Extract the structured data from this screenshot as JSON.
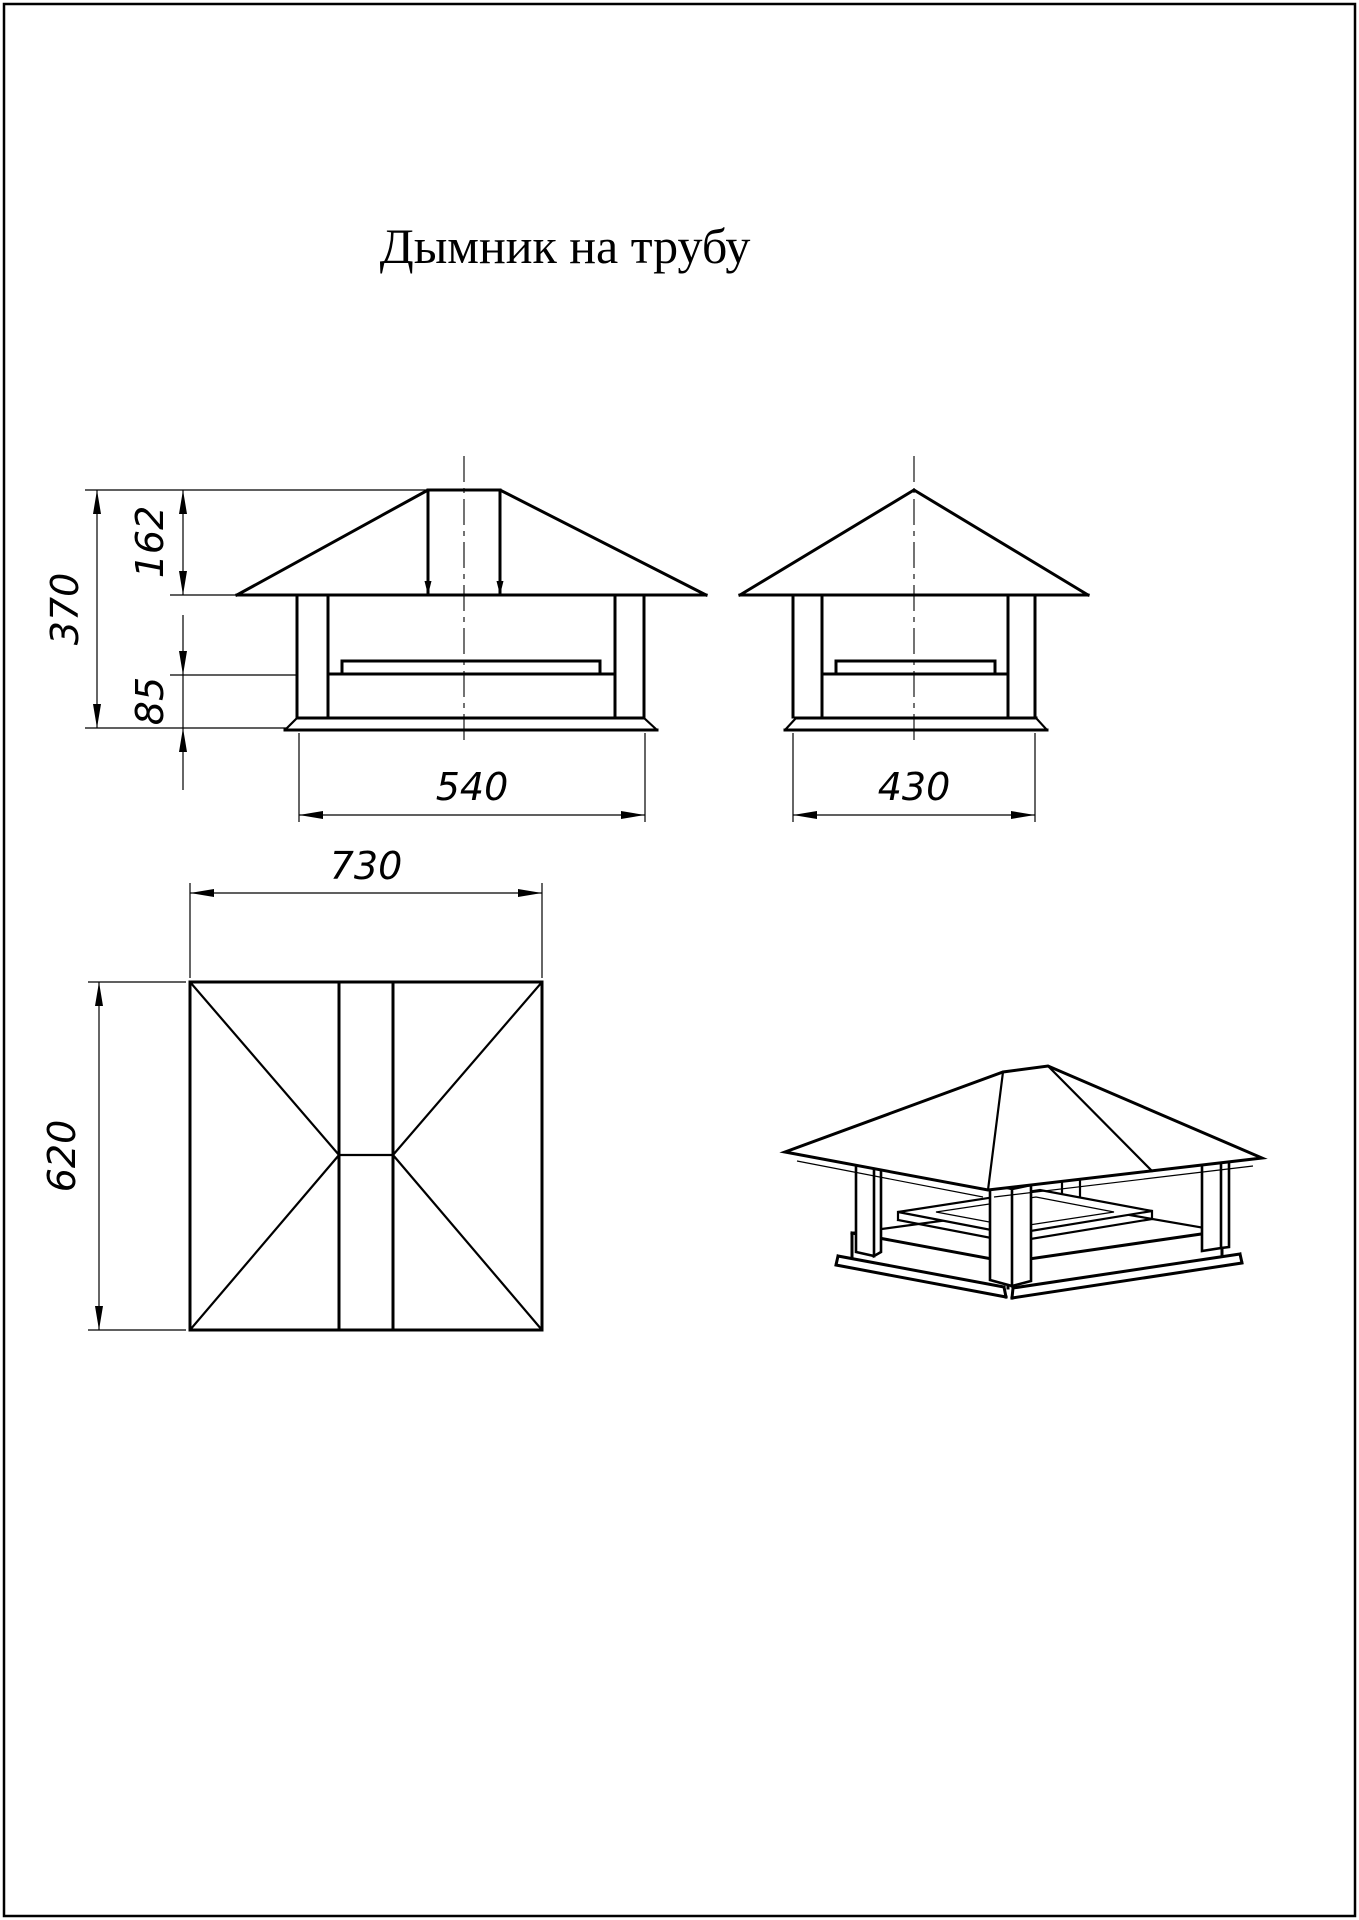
{
  "sheet": {
    "title": "Дымник на трубу"
  },
  "colors": {
    "background": "#ffffff",
    "line": "#000000"
  },
  "dims": {
    "front_total_height": "370",
    "front_roof_height": "162",
    "front_base_height": "85",
    "front_width": "540",
    "side_width": "430",
    "plan_width": "730",
    "plan_depth": "620"
  }
}
